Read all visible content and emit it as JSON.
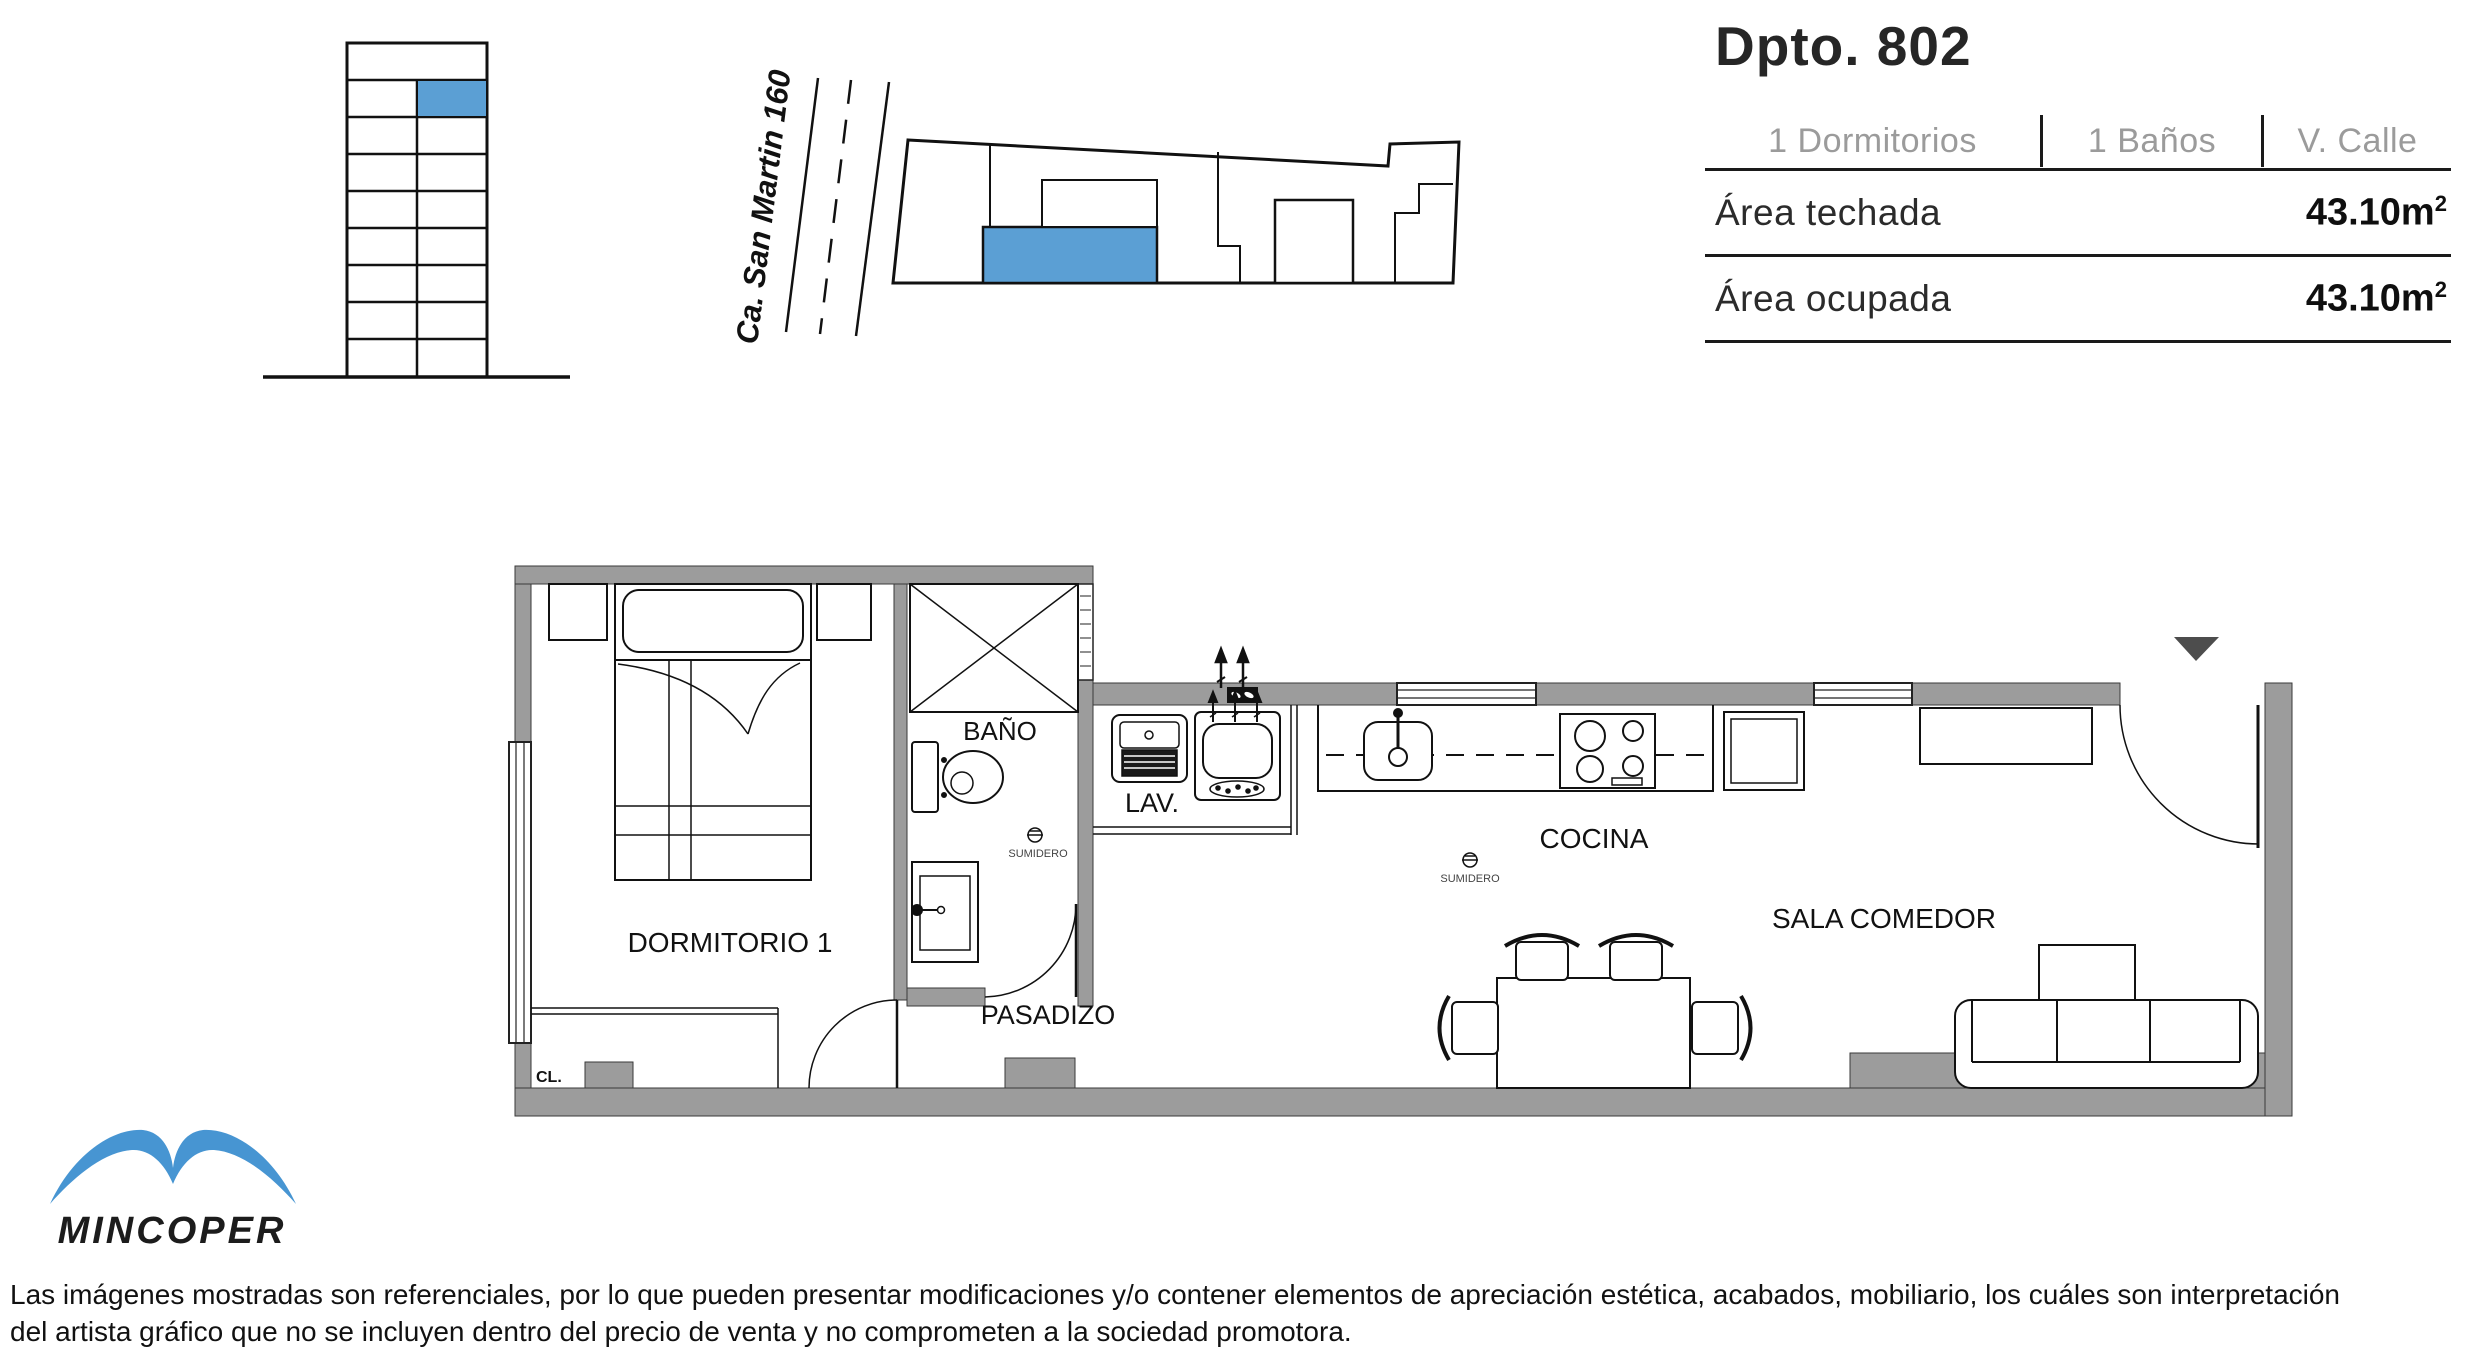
{
  "header": {
    "title": "Dpto. 802",
    "specs": [
      {
        "label": "1 Dormitorios"
      },
      {
        "label": "1 Baños"
      },
      {
        "label": "V. Calle"
      }
    ],
    "areas": [
      {
        "label": "Área techada",
        "value": "43.10m",
        "sup": "2"
      },
      {
        "label": "Área ocupada",
        "value": "43.10m",
        "sup": "2"
      }
    ]
  },
  "site_map": {
    "street_label": "Ca. San Martin 160"
  },
  "elevation": {
    "floors": 9,
    "highlighted_unit": "802"
  },
  "floor_plan": {
    "labels": {
      "dormitorio": "DORMITORIO 1",
      "bano": "BAÑO",
      "lav": "LAV.",
      "pasadizo": "PASADIZO",
      "cocina": "COCINA",
      "sala": "SALA COMEDOR",
      "closet": "CL.",
      "sumidero_bano": "SUMIDERO",
      "sumidero_cocina": "SUMIDERO"
    }
  },
  "logo": {
    "brand": "MINCOPER"
  },
  "disclaimer": {
    "line1": "Las imágenes mostradas son referenciales, por lo que pueden presentar modificaciones y/o contener elementos de apreciación estética, acabados, mobiliario, los cuáles son interpretación",
    "line2": "del artista gráfico que no se incluyen dentro del precio de venta y no comprometen a la sociedad promotora."
  },
  "colors": {
    "highlight_blue": "#5b9fd4",
    "logo_blue": "#4795d2",
    "wall_gray": "#9c9c9c"
  }
}
